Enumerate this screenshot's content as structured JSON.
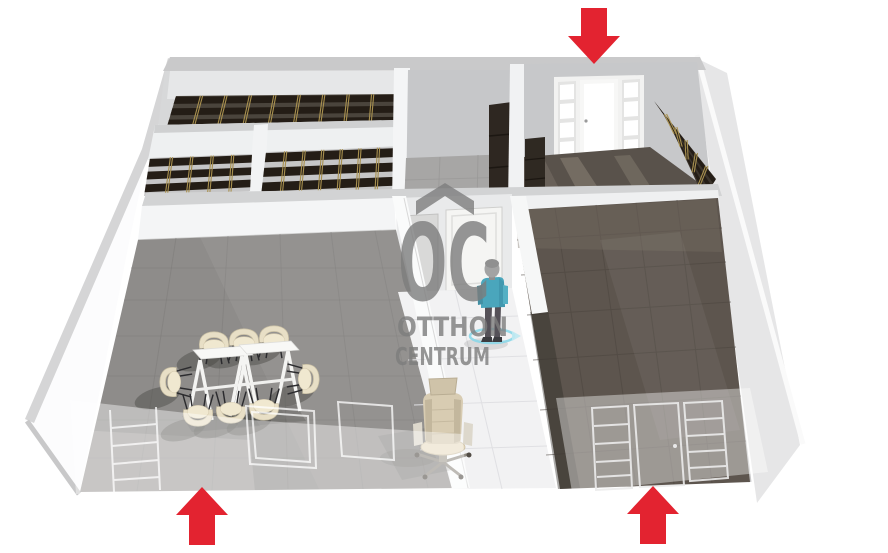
{
  "watermark": {
    "logo": "OC",
    "brand_line1": "OTTHON",
    "brand_line2": "CENTRUM",
    "color": "#7d7d7d",
    "roof_icon": "roof-chevron-up"
  },
  "colors": {
    "arrow_red": "#e32330",
    "wall_white": "#fbfbfd",
    "wall_top_gray": "#cdcdce",
    "wall_shadow_gray": "#c7c8ca",
    "floor_meeting_room": "#8e8c8a",
    "floor_hallway": "#f2f2f3",
    "floor_right_room": "#5d554e",
    "floor_entrance_room": "#59524b",
    "shelf_dark": "#241d16",
    "shelf_brass": "#a8904f",
    "chair_beige": "#e8dfc6",
    "table_white": "#f8f8f6",
    "person_shirt_teal": "#4aa6bc",
    "selection_ring_blue": "#8fd8e8"
  },
  "annotations": {
    "entrance_arrows": [
      {
        "name": "entrance-arrow-top",
        "direction": "down",
        "x": 594,
        "y": 8
      },
      {
        "name": "entrance-arrow-bottom-left",
        "direction": "up",
        "x": 202,
        "y": 545
      },
      {
        "name": "entrance-arrow-bottom-right",
        "direction": "up",
        "x": 653,
        "y": 544
      }
    ]
  },
  "furniture": {
    "chairs": [
      {
        "x": 214,
        "y": 344,
        "rot": 0
      },
      {
        "x": 244,
        "y": 341,
        "rot": 0
      },
      {
        "x": 274,
        "y": 338,
        "rot": 0
      },
      {
        "x": 198,
        "y": 414,
        "rot": 180
      },
      {
        "x": 231,
        "y": 411,
        "rot": 180
      },
      {
        "x": 264,
        "y": 408,
        "rot": 180
      },
      {
        "x": 172,
        "y": 382,
        "rot": -90
      },
      {
        "x": 307,
        "y": 379,
        "rot": 90
      }
    ],
    "tables": [
      {
        "x": 220,
        "y": 358
      },
      {
        "x": 266,
        "y": 353
      }
    ]
  },
  "shelving": {
    "bands": [
      {
        "top": [
          176,
          96,
          396,
          94
        ],
        "bot": [
          166,
          130,
          394,
          127
        ],
        "posts": 8,
        "boards": 3,
        "bg": "#4a443c"
      },
      {
        "top": [
          150,
          158,
          252,
          154
        ],
        "bot": [
          144,
          196,
          250,
          191
        ],
        "posts": 4,
        "boards": 3,
        "bg": "#c6c6c7"
      },
      {
        "top": [
          266,
          152,
          396,
          147
        ],
        "bot": [
          261,
          196,
          394,
          190
        ],
        "posts": 6,
        "boards": 3,
        "bg": "#c6c6c7"
      },
      {
        "top": [
          654,
          101,
          716,
          179
        ],
        "bot": [
          668,
          121,
          704,
          198
        ],
        "posts": 5,
        "boards": 3,
        "bg": "#3b342c"
      }
    ]
  }
}
